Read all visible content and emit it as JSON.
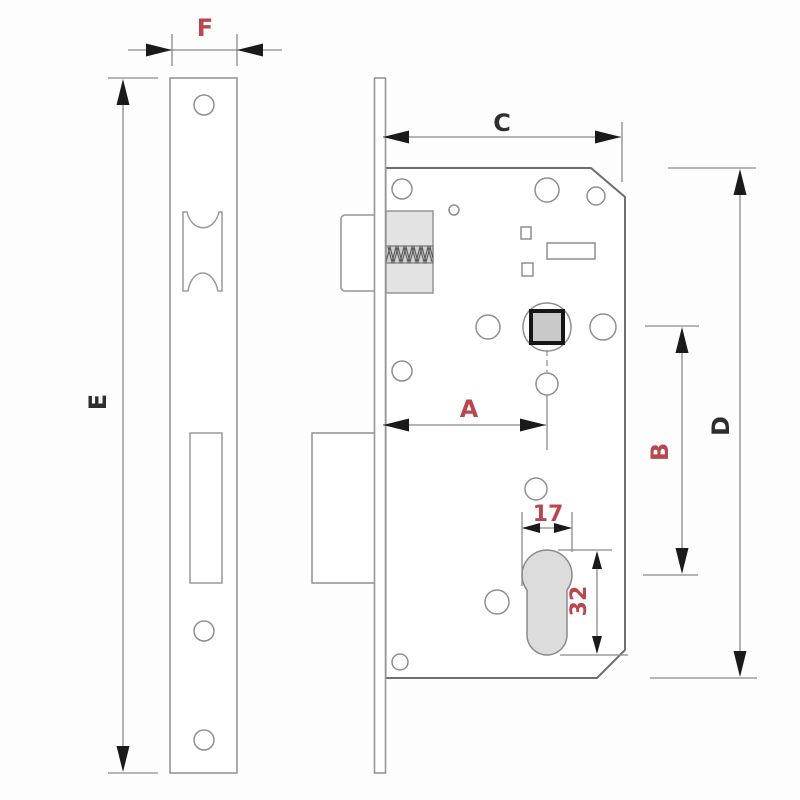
{
  "dimensions": {
    "F": {
      "label": "F",
      "color": "#b8484e"
    },
    "E": {
      "label": "E",
      "color": "#2e2e2e"
    },
    "C": {
      "label": "C",
      "color": "#2e2e2e"
    },
    "D": {
      "label": "D",
      "color": "#2e2e2e"
    },
    "A": {
      "label": "A",
      "color": "#b8484e"
    },
    "B": {
      "label": "B",
      "color": "#b8484e"
    },
    "cylinder_width": {
      "label": "17",
      "color": "#b8484e"
    },
    "cylinder_height": {
      "label": "32",
      "color": "#b8484e"
    }
  },
  "colors": {
    "background": "#fdfdfd",
    "part_outline": "#969696",
    "body_outline": "#6e6e6e",
    "dimension_line": "#8a8a8a",
    "arrow": "#1a1a1a",
    "label_red": "#b8484e",
    "label_dark": "#2e2e2e",
    "latch_block_fill": "#e3e3e3",
    "cylinder_fill": "#dcdcdc",
    "follower_square_fill": "#c9c9c9"
  }
}
